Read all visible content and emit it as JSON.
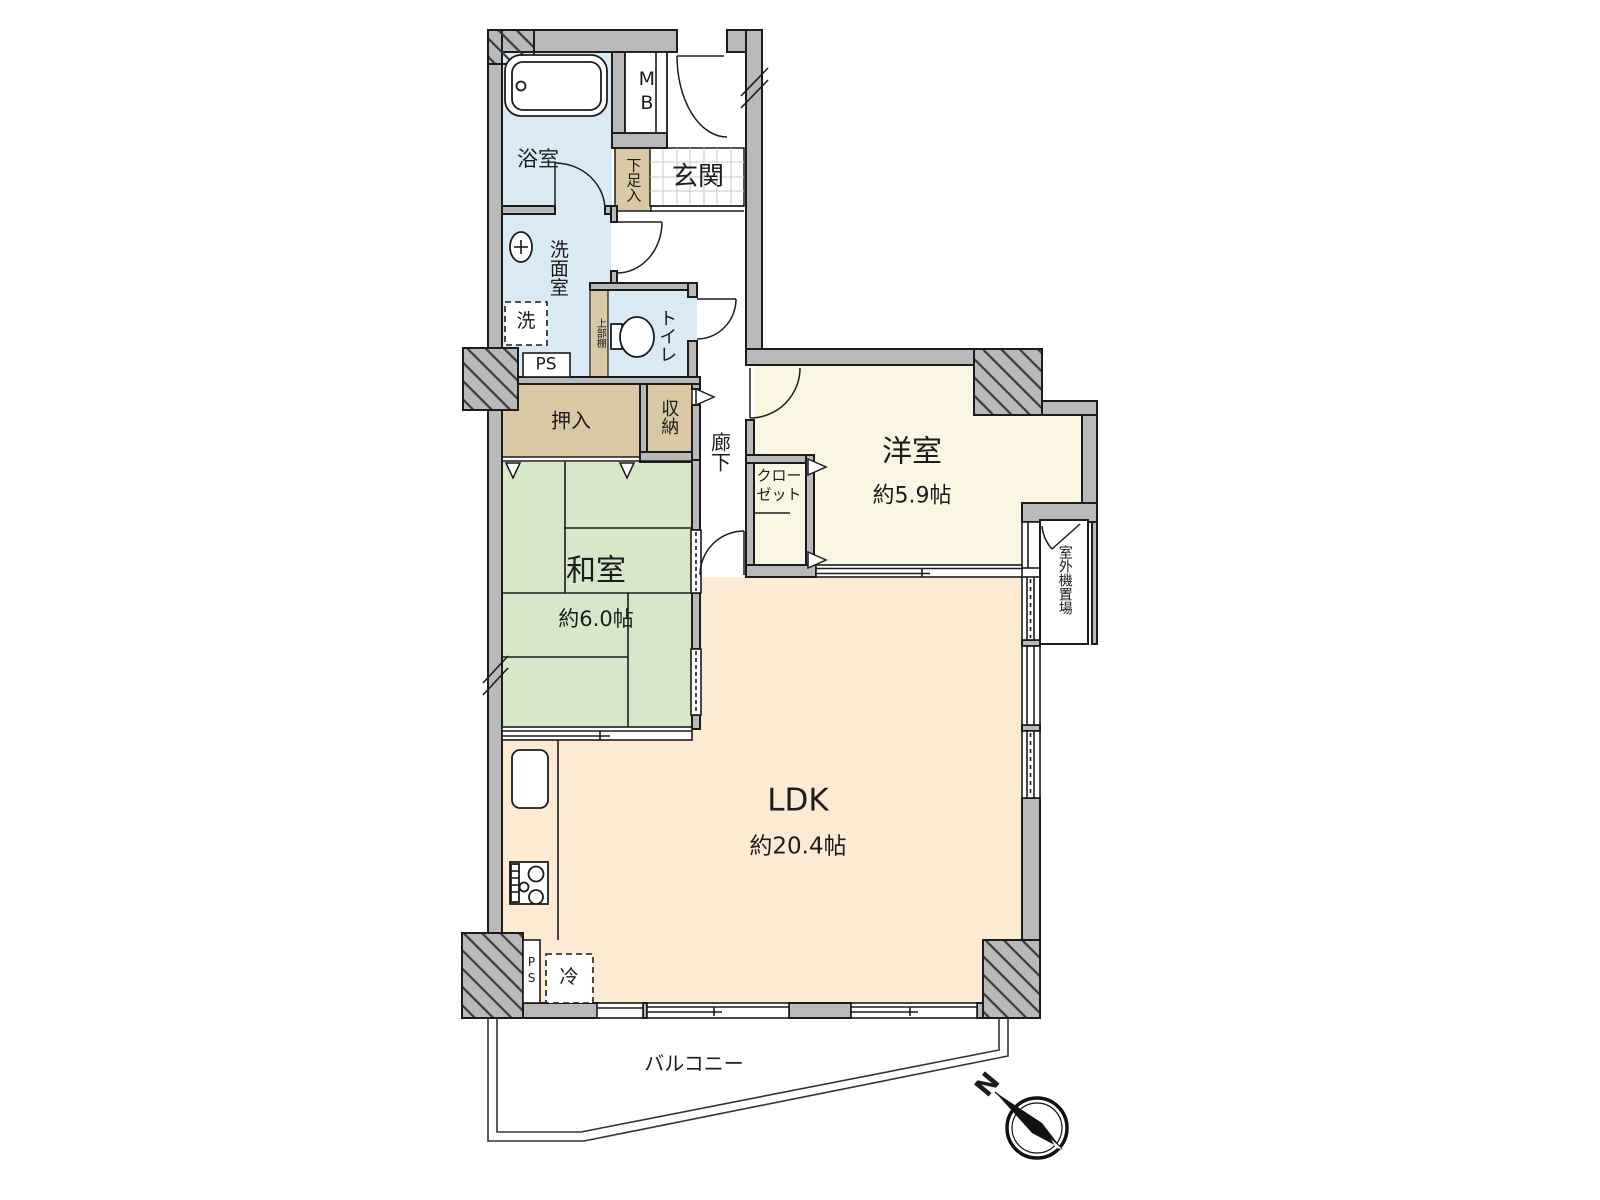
{
  "floor_plan": {
    "title": "2LDK apartment floor plan",
    "colors": {
      "wall": "#b9b9b9",
      "line": "#1c1c1c",
      "wet_room": "#daeaf5",
      "tatami": "#d7e8c8",
      "western": "#faf6e2",
      "ldk": "#fcead3",
      "storage": "#d9c8a4",
      "tile_line": "#c9c9c9"
    },
    "rooms": {
      "bathroom": {
        "label": "浴室"
      },
      "meter_box": {
        "label": "MB"
      },
      "entrance": {
        "label": "玄関"
      },
      "shoe_storage": {
        "label": "下足入"
      },
      "washroom": {
        "label": "洗面室"
      },
      "washer": {
        "label": "洗"
      },
      "pipe_space_top": {
        "label": "PS"
      },
      "toilet": {
        "label": "トイレ"
      },
      "upper_shelf": {
        "label": "上部棚"
      },
      "oshiire": {
        "label": "押入"
      },
      "storage": {
        "label": "収納"
      },
      "hallway": {
        "label": "廊下"
      },
      "closet": {
        "label": "クローゼット"
      },
      "western_room": {
        "label": "洋室",
        "area": "約5.9帖"
      },
      "japanese_room": {
        "label": "和室",
        "area": "約6.0帖"
      },
      "ldk": {
        "label": "LDK",
        "area": "約20.4帖"
      },
      "outdoor_unit_space": {
        "label": "室外機置場"
      },
      "refrigerator": {
        "label": "冷"
      },
      "pipe_space_bottom": {
        "label": "PS"
      },
      "balcony": {
        "label": "バルコニー"
      }
    },
    "compass": {
      "north": "N"
    }
  }
}
